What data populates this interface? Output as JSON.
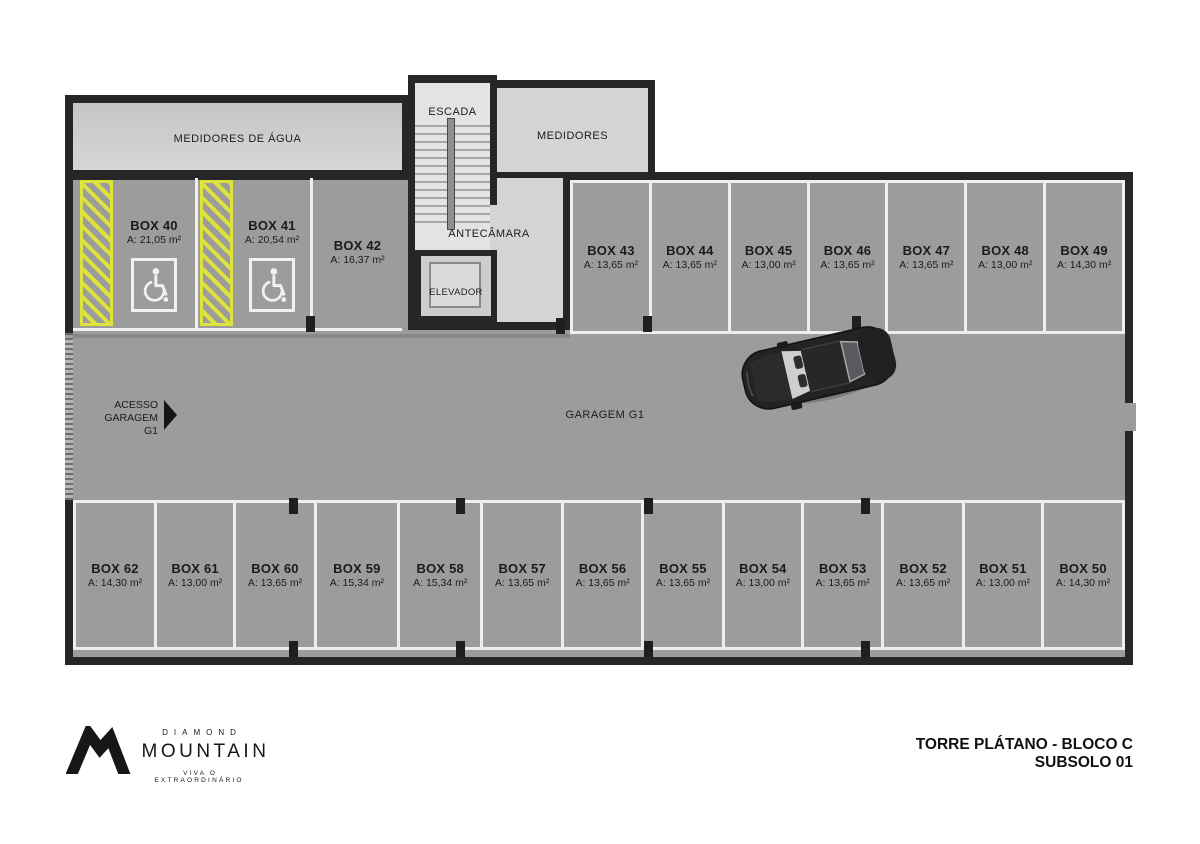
{
  "title": {
    "line1": "TORRE PLÁTANO - BLOCO C",
    "line2": "SUBSOLO 01"
  },
  "branding": {
    "top": "DIAMOND",
    "name": "MOUNTAIN",
    "tagline": "VIVA O EXTRAORDINÁRIO"
  },
  "rooms": {
    "water_meters": "MEDIDORES DE ÁGUA",
    "stairs": "ESCADA",
    "meters": "MEDIDORES",
    "antechamber": "ANTECÂMARA",
    "elevator": "ELEVADOR",
    "garage": "GARAGEM G1",
    "access_line1": "ACESSO",
    "access_line2": "GARAGEM G1"
  },
  "stalls": {
    "upper_left": [
      {
        "label": "BOX 40",
        "area": "A: 21,05 m²",
        "accessible": true
      },
      {
        "label": "BOX 41",
        "area": "A: 20,54 m²",
        "accessible": true
      },
      {
        "label": "BOX 42",
        "area": "A: 16,37 m²",
        "accessible": false
      }
    ],
    "upper_right": [
      {
        "label": "BOX 43",
        "area": "A: 13,65 m²"
      },
      {
        "label": "BOX 44",
        "area": "A: 13,65 m²"
      },
      {
        "label": "BOX 45",
        "area": "A: 13,00 m²"
      },
      {
        "label": "BOX 46",
        "area": "A: 13,65 m²"
      },
      {
        "label": "BOX 47",
        "area": "A: 13,65 m²"
      },
      {
        "label": "BOX 48",
        "area": "A: 13,00 m²"
      },
      {
        "label": "BOX 49",
        "area": "A: 14,30 m²"
      }
    ],
    "bottom": [
      {
        "label": "BOX 62",
        "area": "A: 14,30 m²"
      },
      {
        "label": "BOX 61",
        "area": "A: 13,00 m²"
      },
      {
        "label": "BOX 60",
        "area": "A: 13,65 m²"
      },
      {
        "label": "BOX 59",
        "area": "A: 15,34 m²"
      },
      {
        "label": "BOX 58",
        "area": "A: 15,34 m²"
      },
      {
        "label": "BOX 57",
        "area": "A: 13,65 m²"
      },
      {
        "label": "BOX 56",
        "area": "A: 13,65 m²"
      },
      {
        "label": "BOX 55",
        "area": "A: 13,65 m²"
      },
      {
        "label": "BOX 54",
        "area": "A: 13,00 m²"
      },
      {
        "label": "BOX 53",
        "area": "A: 13,65 m²"
      },
      {
        "label": "BOX 52",
        "area": "A: 13,65 m²"
      },
      {
        "label": "BOX 51",
        "area": "A: 13,00 m²"
      },
      {
        "label": "BOX 50",
        "area": "A: 14,30 m²"
      }
    ]
  },
  "colors": {
    "accent_yellow": "#dde23c",
    "floor_gray": "#9c9c9c",
    "room_light_gray": "#d6d4d2",
    "wall_black": "#262626",
    "stall_line_white": "#efeeec"
  }
}
